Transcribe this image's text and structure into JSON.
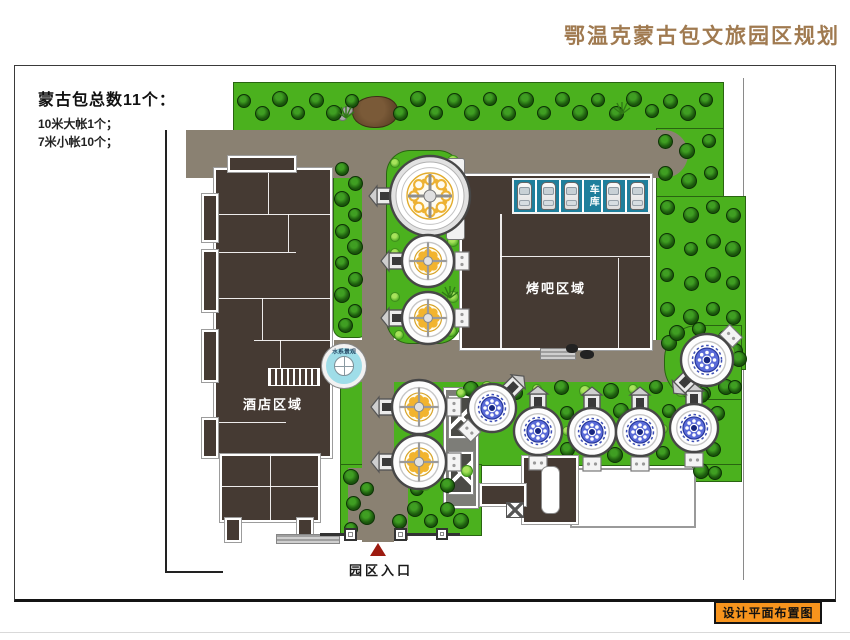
{
  "title": "鄂温克蒙古包文旅园区规划",
  "legend": {
    "heading": "蒙古包总数11个：",
    "large": "10米大帐1个；",
    "small": "7米小帐10个；"
  },
  "areas": {
    "hotel": "酒店区域",
    "bbq": "烤吧区域",
    "garage": "车库",
    "water": "水系景观",
    "entrance": "园区入口"
  },
  "footer": {
    "caption": "设计平面布置图"
  },
  "garage": {
    "car_count": 5
  },
  "yurts": [
    {
      "type": "large-10m",
      "x": 430,
      "y": 196,
      "r": 40,
      "style": "gold-large",
      "porch": -90,
      "box": false
    },
    {
      "type": "small-7m",
      "x": 428,
      "y": 261,
      "r": 26,
      "style": "gold",
      "porch": -90,
      "box": true
    },
    {
      "type": "small-7m",
      "x": 428,
      "y": 318,
      "r": 26,
      "style": "gold",
      "porch": -90,
      "box": true
    },
    {
      "type": "small-7m",
      "x": 419,
      "y": 407,
      "r": 27,
      "style": "gold",
      "porch": -90,
      "box": true
    },
    {
      "type": "small-7m",
      "x": 419,
      "y": 462,
      "r": 27,
      "style": "gold",
      "porch": -90,
      "box": true
    },
    {
      "type": "small-7m",
      "x": 492,
      "y": 408,
      "r": 24,
      "style": "blue",
      "porch": 45,
      "box": true
    },
    {
      "type": "small-7m",
      "x": 538,
      "y": 431,
      "r": 24,
      "style": "blue",
      "porch": 0,
      "box": true
    },
    {
      "type": "small-7m",
      "x": 592,
      "y": 432,
      "r": 24,
      "style": "blue",
      "porch": 0,
      "box": true
    },
    {
      "type": "small-7m",
      "x": 640,
      "y": 432,
      "r": 24,
      "style": "blue",
      "porch": 0,
      "box": true
    },
    {
      "type": "small-7m",
      "x": 694,
      "y": 428,
      "r": 24,
      "style": "blue",
      "porch": 0,
      "box": true
    },
    {
      "type": "small-7m",
      "x": 707,
      "y": 360,
      "r": 26,
      "style": "blue",
      "porch": -135,
      "box": true
    }
  ],
  "palette": {
    "green": "#4bb11e",
    "road": "#8a8172",
    "building": "#453a33",
    "teal": "#1f7f9c",
    "water": "#9fdde8",
    "orange": "#f7941d",
    "brown": "#a07a50",
    "red": "#9d1b10"
  }
}
